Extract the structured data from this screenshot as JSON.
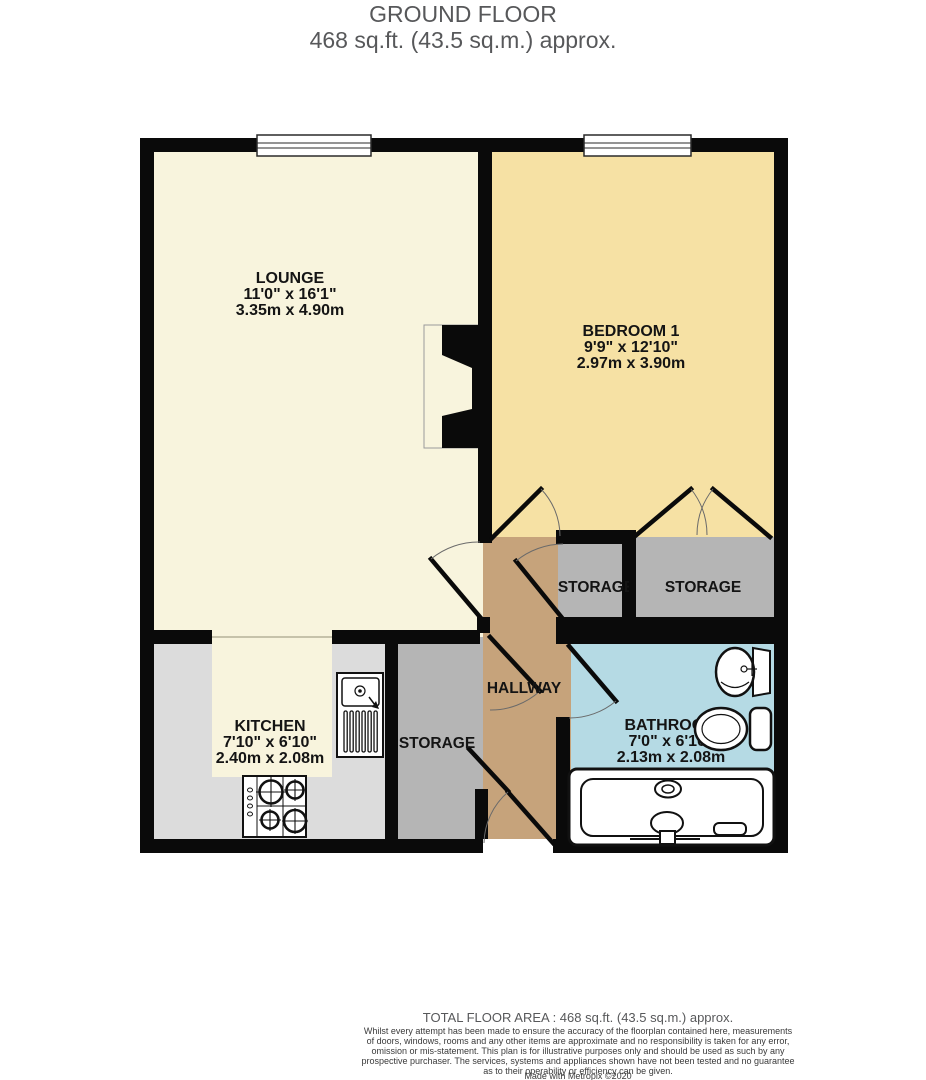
{
  "title": {
    "line1": "GROUND FLOOR",
    "line2": "468 sq.ft. (43.5 sq.m.) approx."
  },
  "rooms": {
    "lounge": {
      "name": "LOUNGE",
      "imperial": "11'0\"  x 16'1\"",
      "metric": "3.35m  x 4.90m"
    },
    "bedroom1": {
      "name": "BEDROOM 1",
      "imperial": "9'9\"  x 12'10\"",
      "metric": "2.97m  x 3.90m"
    },
    "kitchen": {
      "name": "KITCHEN",
      "imperial": "7'10\"  x 6'10\"",
      "metric": "2.40m  x 2.08m"
    },
    "bathroom": {
      "name": "BATHROOM",
      "imperial": "7'0\"  x 6'10\"",
      "metric": "2.13m  x 2.08m"
    },
    "hallway": {
      "name": "HALLWAY"
    },
    "storage_left": {
      "name": "STORAGE"
    },
    "storage_middle": {
      "name": "STORAGE"
    },
    "storage_right": {
      "name": "STORAGE"
    }
  },
  "footer": {
    "total": "TOTAL FLOOR AREA : 468 sq.ft. (43.5 sq.m.) approx.",
    "disclaimer_lines": [
      "Whilst every attempt has been made to ensure the accuracy of the floorplan contained here, measurements",
      "of doors, windows, rooms and any other items are approximate and no responsibility is taken for any error,",
      "omission or mis-statement. This plan is for illustrative purposes only and should be used as such by any",
      "prospective purchaser. The services, systems and appliances shown have not been tested and no guarantee",
      "as to their operability or efficiency can be given."
    ],
    "credit": "Made with Metropix ©2020"
  },
  "colors": {
    "lounge": "#f8f4dd",
    "bedroom": "#f6e1a4",
    "kitchen_counter": "#dcdcdc",
    "kitchen_floor": "#f8f4dd",
    "hallway": "#c6a37b",
    "storage": "#b5b5b5",
    "bathroom": "#b5dae4",
    "wall": "#0a0a0a",
    "title_gray": "#57585a"
  }
}
